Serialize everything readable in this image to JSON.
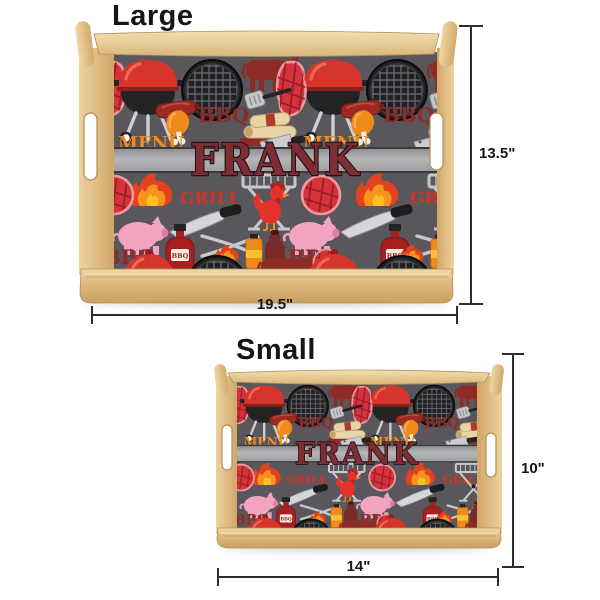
{
  "page": {
    "background": "#ffffff"
  },
  "sections": {
    "large": {
      "title": "Large",
      "height_label": "13.5\"",
      "width_label": "19.5\""
    },
    "small": {
      "title": "Small",
      "height_label": "10\"",
      "width_label": "14\""
    }
  },
  "tray": {
    "personalized_name": "FRANK",
    "pattern_words": {
      "bbq": "BBQ",
      "grill": "GRILL",
      "menu": "MENU"
    },
    "colors": {
      "wood_light": "#f2dcab",
      "wood_mid": "#e3c189",
      "wood_dark": "#c89e63",
      "wood_edge": "#b2905c",
      "pattern_background": "#59575b",
      "name_band": "#b3b3b6",
      "band_border": "#3a3a3d",
      "name_text": "#7e2d35",
      "name_outline": "#241015",
      "red": "#d6352c",
      "dark_red": "#8f2b26",
      "steak_red": "#d5333c",
      "orange": "#ee8c1f",
      "yellow": "#fbc12d",
      "pink": "#f2a3c0",
      "utensil_gray": "#c7c8cb",
      "black": "#232326",
      "dimension_line": "#2e2e30"
    }
  }
}
